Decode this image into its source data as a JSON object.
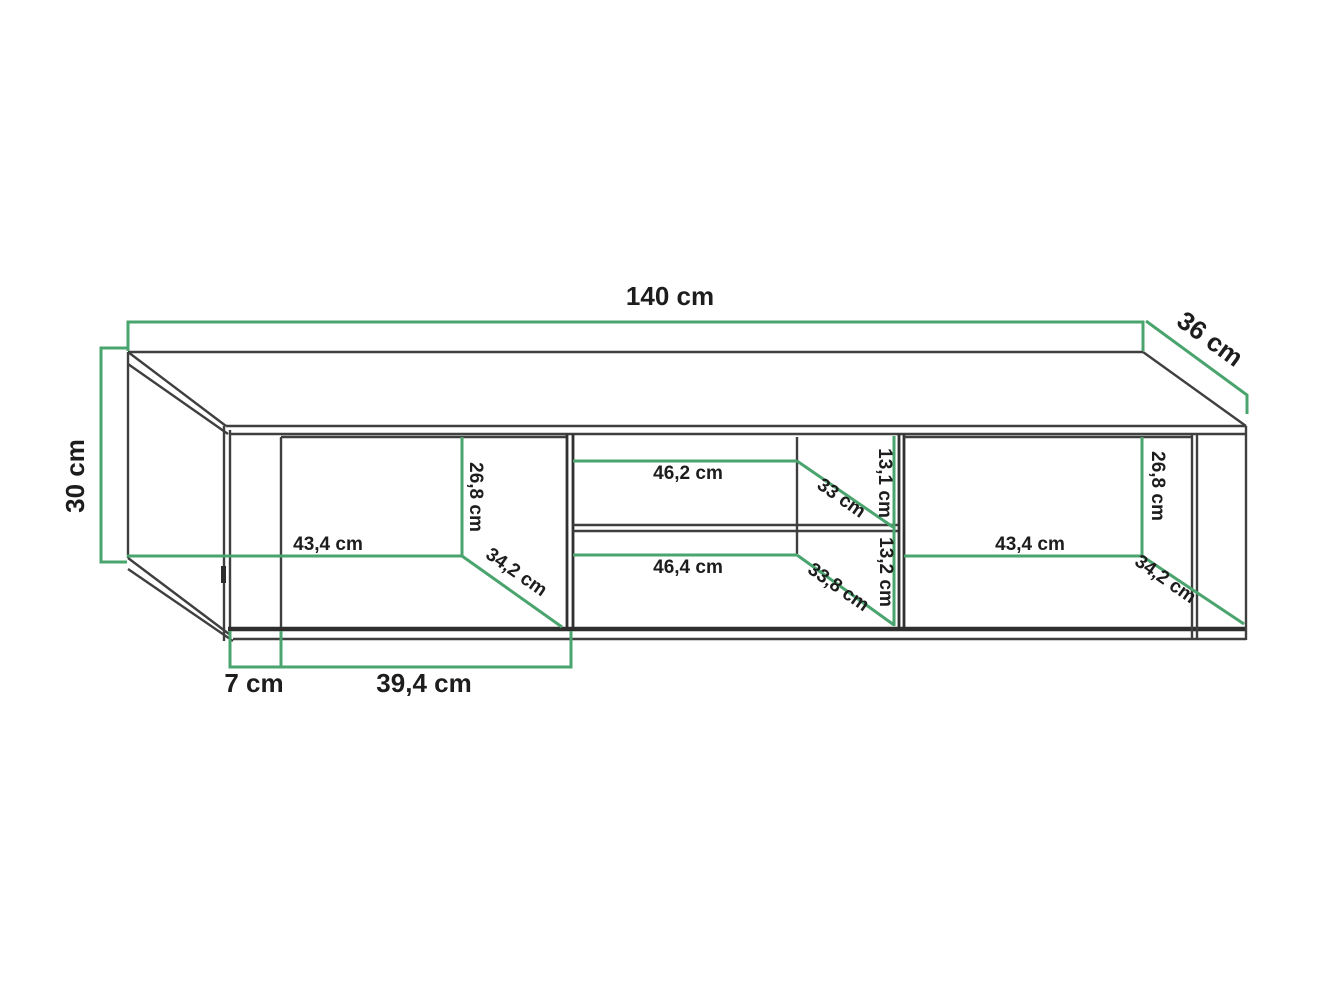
{
  "diagram": {
    "kind": "furniture-dimension-drawing",
    "unit": "cm",
    "colors": {
      "dimension_line": "#4aa46d",
      "outline": "#3f3f3f",
      "outline_dark": "#2e2e2e",
      "label_text": "#1d1d1d",
      "background": "#ffffff"
    },
    "overall": {
      "width": "140 cm",
      "depth": "36 cm",
      "height": "30 cm"
    },
    "left_compartment": {
      "opening_height": "26,8 cm",
      "opening_width": "43,4 cm",
      "opening_depth": "34,2 cm"
    },
    "middle_upper_shelf": {
      "width": "46,2 cm",
      "depth": "33 cm",
      "opening_height": "13,1 cm"
    },
    "middle_lower_shelf": {
      "width": "46,4 cm",
      "depth": "33,8 cm",
      "opening_height": "13,2 cm"
    },
    "right_compartment": {
      "opening_height": "26,8 cm",
      "opening_width": "43,4 cm",
      "opening_depth": "34,2 cm"
    },
    "base": {
      "side_panel_width": "7 cm",
      "door_width": "39,4 cm"
    }
  }
}
